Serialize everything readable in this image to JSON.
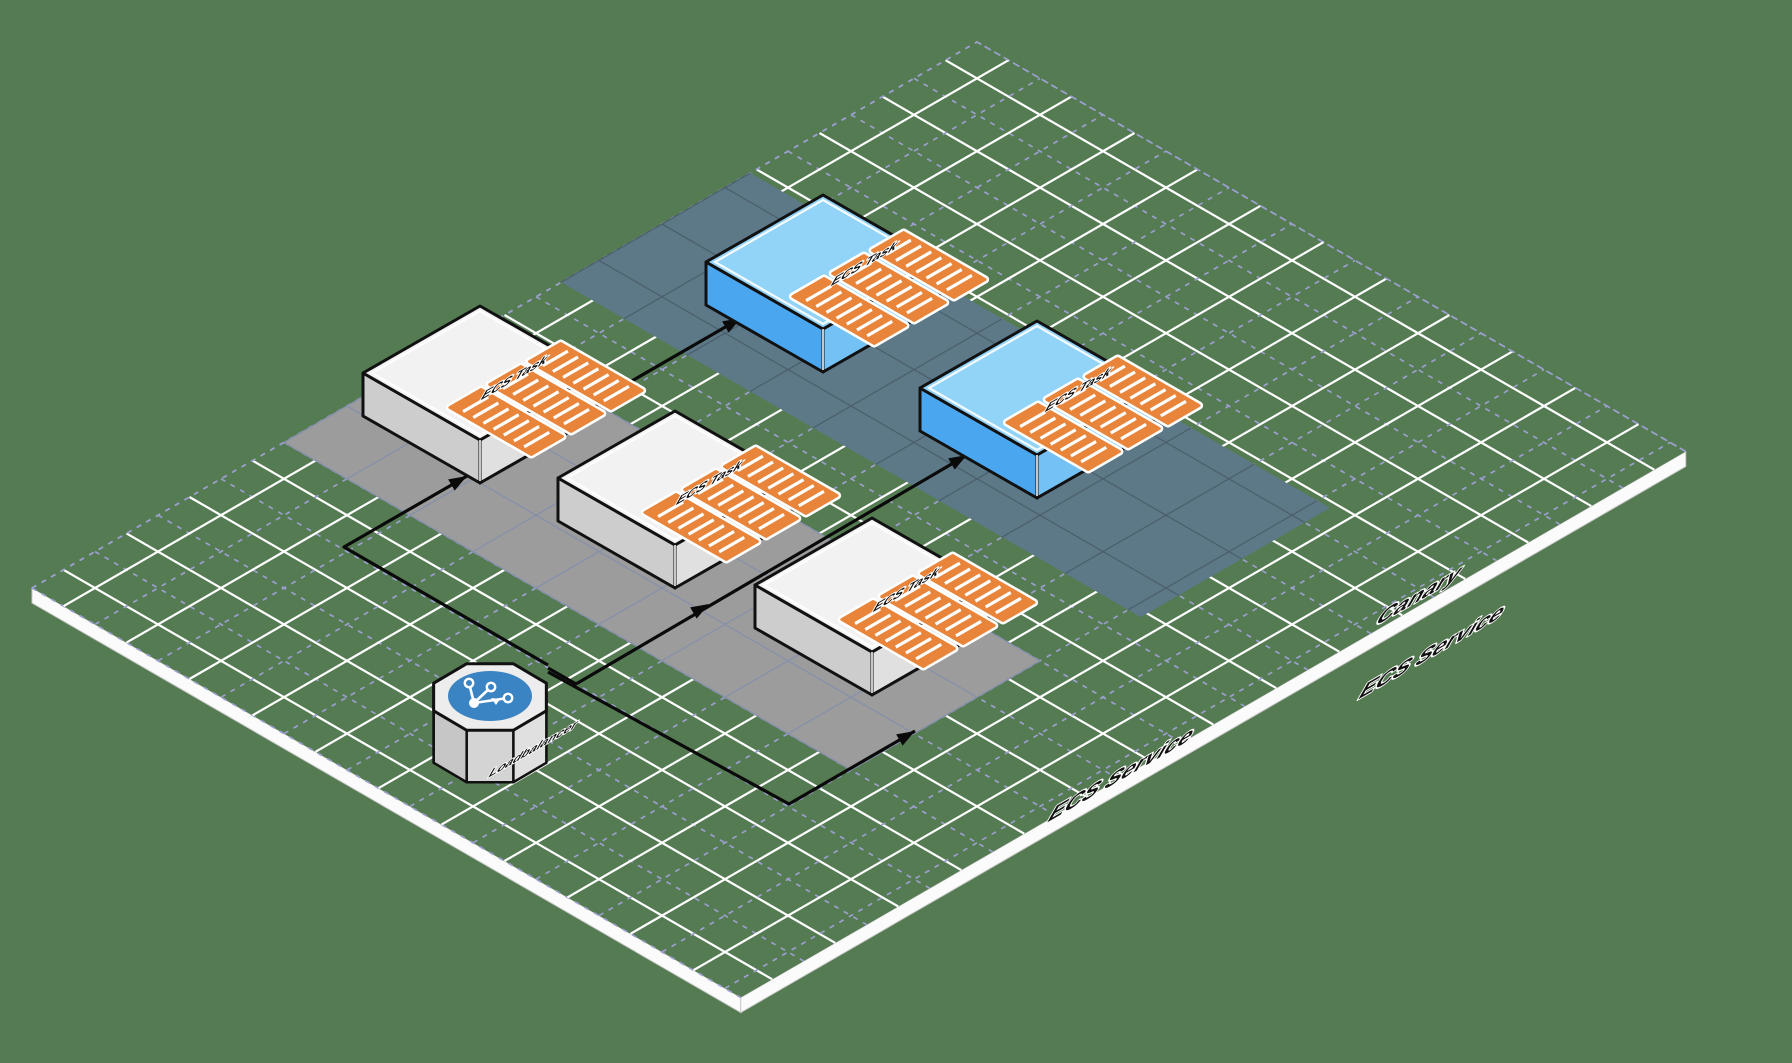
{
  "colors": {
    "background": "#557B53",
    "grid_major_line": "#FFFFFF",
    "grid_minor_line": "#9B9FCE",
    "platform_edge": "#FBFBFB",
    "platform_edge_shade": "#C9C9C9",
    "zone_ecs_service_fill": "#9C9C9C",
    "zone_ecs_service_grid": "#8790AB",
    "zone_canary_fill": "#5D7988",
    "zone_canary_grid": "#4C5F6D",
    "task_top": "#F2F2F2",
    "task_side_left": "#CDCDCD",
    "task_side_right": "#E0E0E0",
    "canary_task_top": "#92D3F8",
    "canary_task_side_left": "#4AA7EF",
    "canary_task_side_right": "#74C2F5",
    "container_fill": "#E8853B",
    "container_stripe": "#FFFFFF",
    "outline": "#111111",
    "connector": "#0A0A0A",
    "load_balancer_badge": "#3B84C4"
  },
  "zones": {
    "ecs_service": {
      "label": "ECS Service"
    },
    "canary": {
      "label_line1": "Canary",
      "label_line2": "ECS Service"
    }
  },
  "nodes": {
    "load_balancer": {
      "label": "Loadbalancer",
      "icon": "share-nodes-icon"
    },
    "tasks": [
      {
        "label": "ECS Task",
        "variant": "standard"
      },
      {
        "label": "ECS Task",
        "variant": "standard"
      },
      {
        "label": "ECS Task",
        "variant": "standard"
      },
      {
        "label": "ECS Task",
        "variant": "canary"
      },
      {
        "label": "ECS Task",
        "variant": "canary"
      }
    ]
  }
}
